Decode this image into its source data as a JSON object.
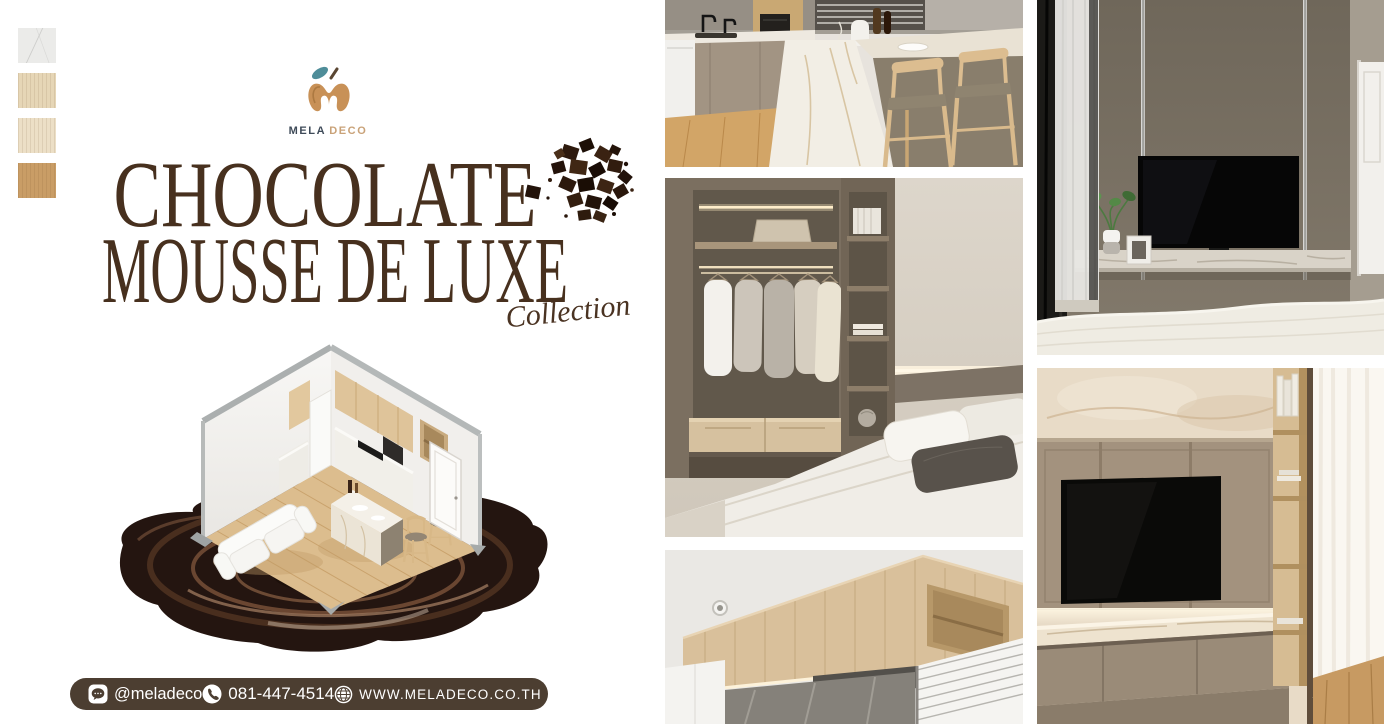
{
  "brand": {
    "name_primary": "MELA",
    "name_secondary": "DECO",
    "logo_icon": "apple-monogram-with-leaf",
    "leaf_color": "#4f8d99",
    "apple_color": "#c89157"
  },
  "swatches": [
    {
      "name": "white-marble",
      "color": "#ebebe9"
    },
    {
      "name": "light-beige-wood",
      "color": "#e6d6b6"
    },
    {
      "name": "cream-wood",
      "color": "#ecdfc6"
    },
    {
      "name": "natural-oak-wood",
      "color": "#c99d66"
    }
  ],
  "title": {
    "line1": "CHOCOLATE",
    "line2": "MOUSSE DE LUXE",
    "subtitle": "Collection",
    "color": "#47301e"
  },
  "decor": {
    "chunks_icon": "chocolate-chunks",
    "pool_icon": "melted-chocolate-pool",
    "room_icon": "isometric-studio-room-3d-render"
  },
  "contact": {
    "bar_color": "#4c3e31",
    "line_icon": "line-messenger",
    "line_id": "@meladeco",
    "phone_icon": "phone-handset",
    "phone": "081-447-4514",
    "globe_icon": "globe",
    "website": "WWW.MELADECO.CO.TH"
  },
  "photos": [
    {
      "name": "kitchen-island-with-bar-stools"
    },
    {
      "name": "bedroom-walk-in-closet"
    },
    {
      "name": "kitchen-wood-cabinets"
    },
    {
      "name": "bedroom-tv-wall"
    },
    {
      "name": "living-room-tv-wall"
    }
  ]
}
